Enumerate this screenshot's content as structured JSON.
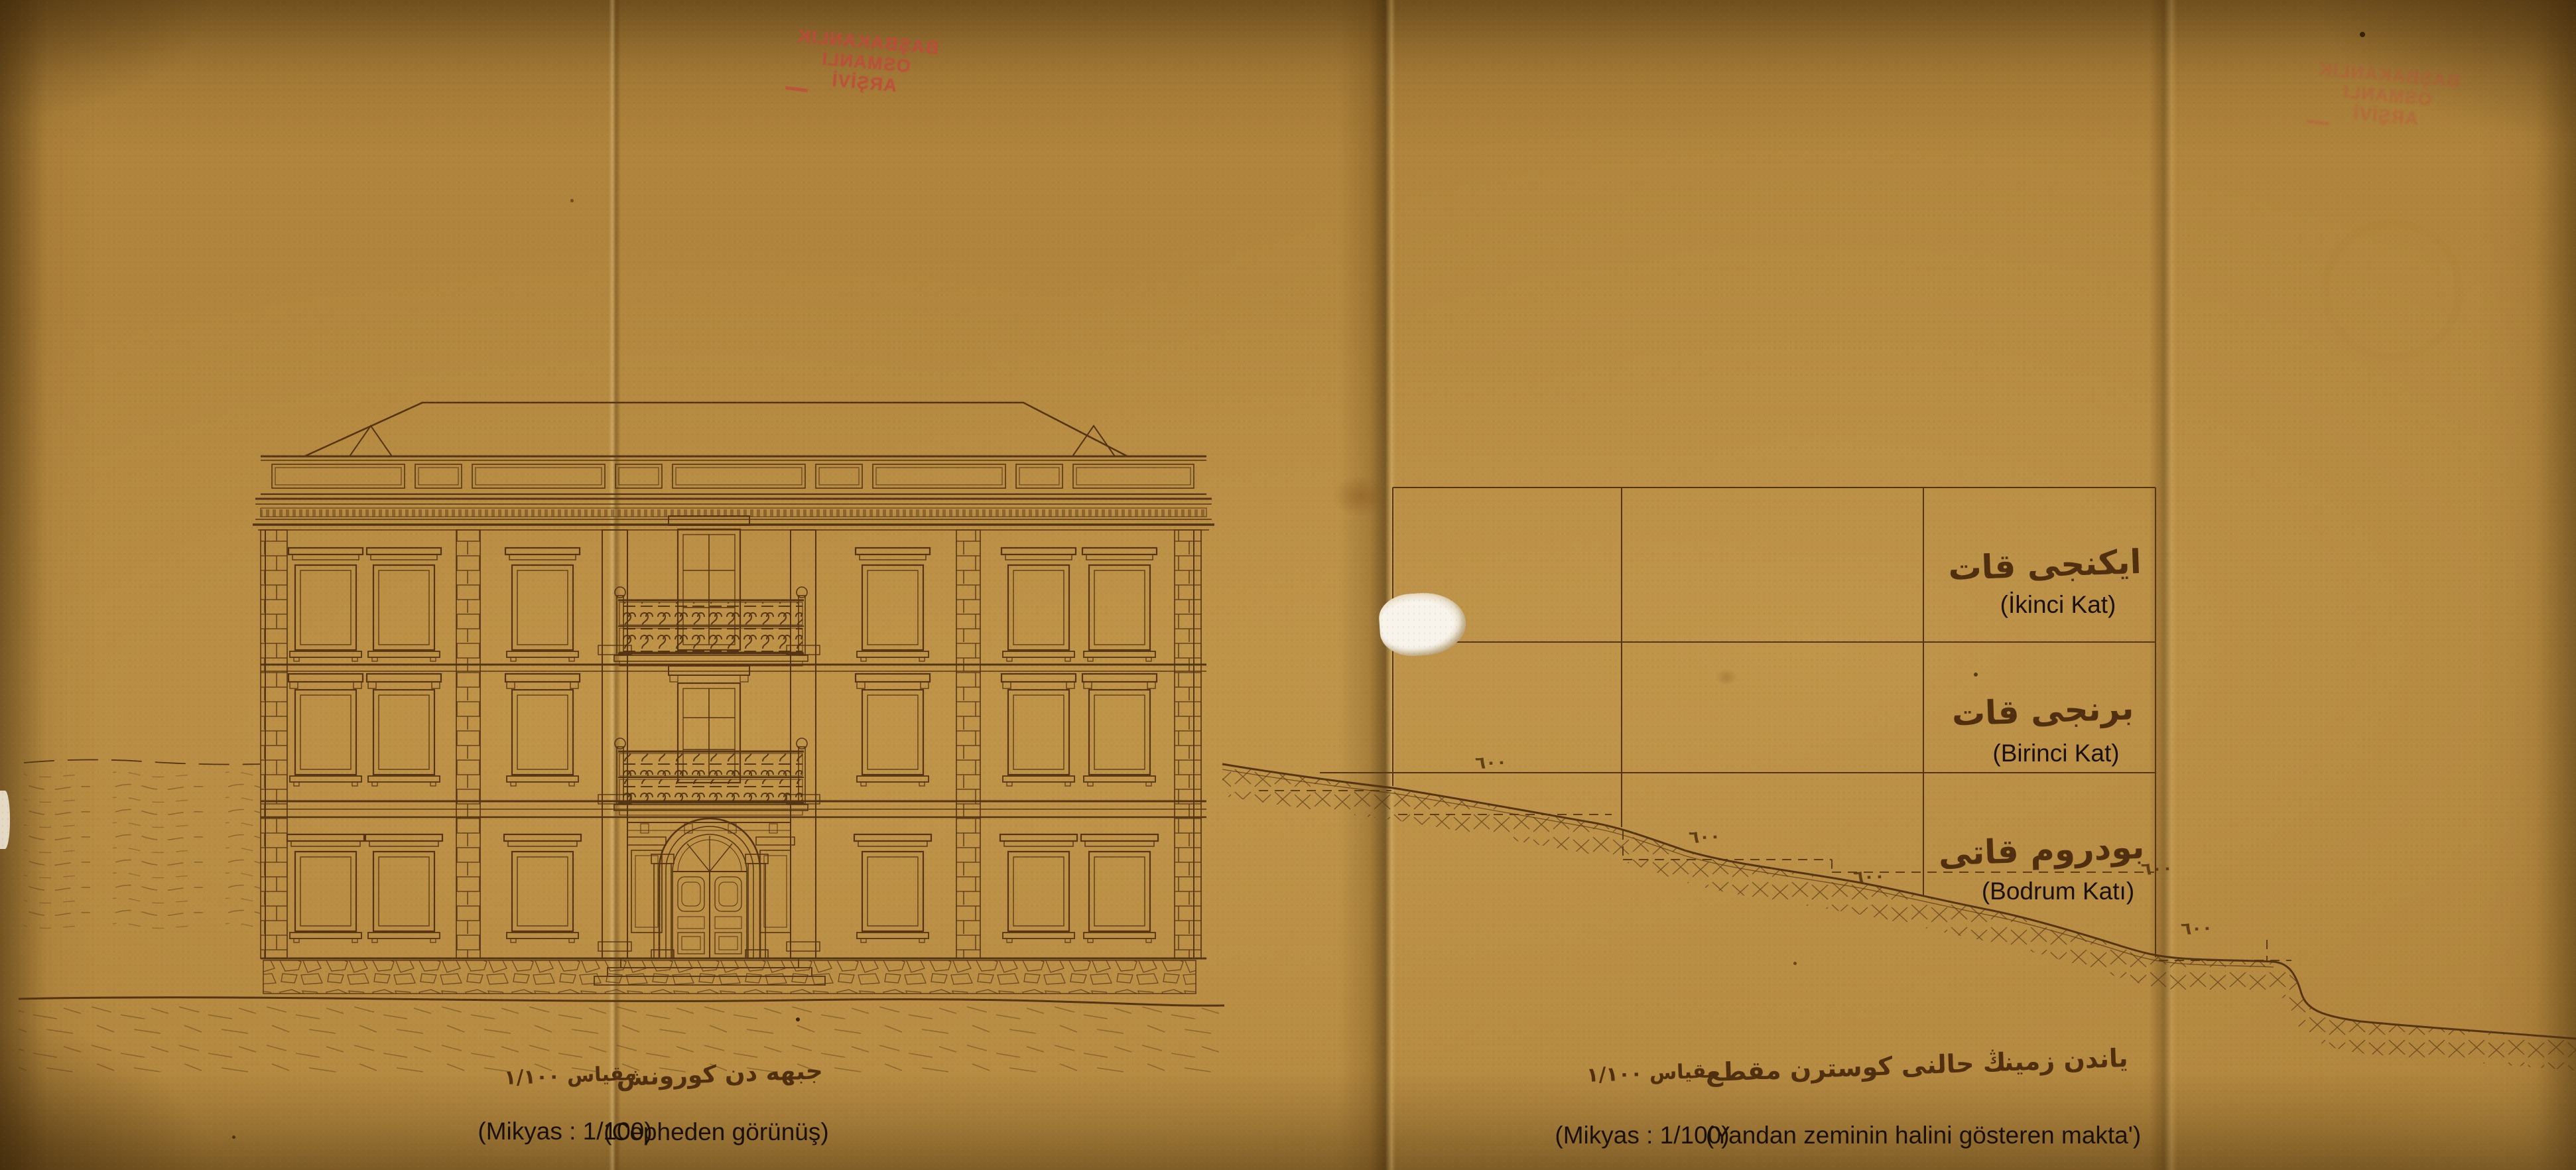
{
  "colors": {
    "paper": "#b0843c",
    "ink": "#543415",
    "stamp_red": "#c2493d",
    "label_ink": "#1a1007"
  },
  "stamp": {
    "line1": "BAŞBAKANLIK",
    "line2": "OSMANLI",
    "line3": "ARŞİVİ"
  },
  "facade_captions": {
    "scale_ottoman": "مقياس ١/١٠٠",
    "scale_latin": "(Mikyas : 1/100)",
    "title_ottoman": "جبهه دن كورونش",
    "title_latin": "(Cepheden görünüş)"
  },
  "section": {
    "floors": [
      {
        "ottoman": "ايكنجى قات",
        "latin": "(İkinci Kat)"
      },
      {
        "ottoman": "برنجى قات",
        "latin": "(Birinci Kat)"
      },
      {
        "ottoman": "بودروم قاتى",
        "latin": "(Bodrum Katı)"
      }
    ],
    "dims": {
      "d1": "٦٠٠",
      "d2": "٦٠٠",
      "d3": "٦٠٠",
      "d4": "٦٠٠",
      "d5": "٦٠٠"
    },
    "scale_ottoman": "مقياس ١/١٠٠",
    "scale_latin": "(Mikyas : 1/100)",
    "title_ottoman": "ياندن زمينڭ حالنى كوسترن مقطع",
    "title_latin": "(Yandan zeminin halini gösteren makta')"
  }
}
